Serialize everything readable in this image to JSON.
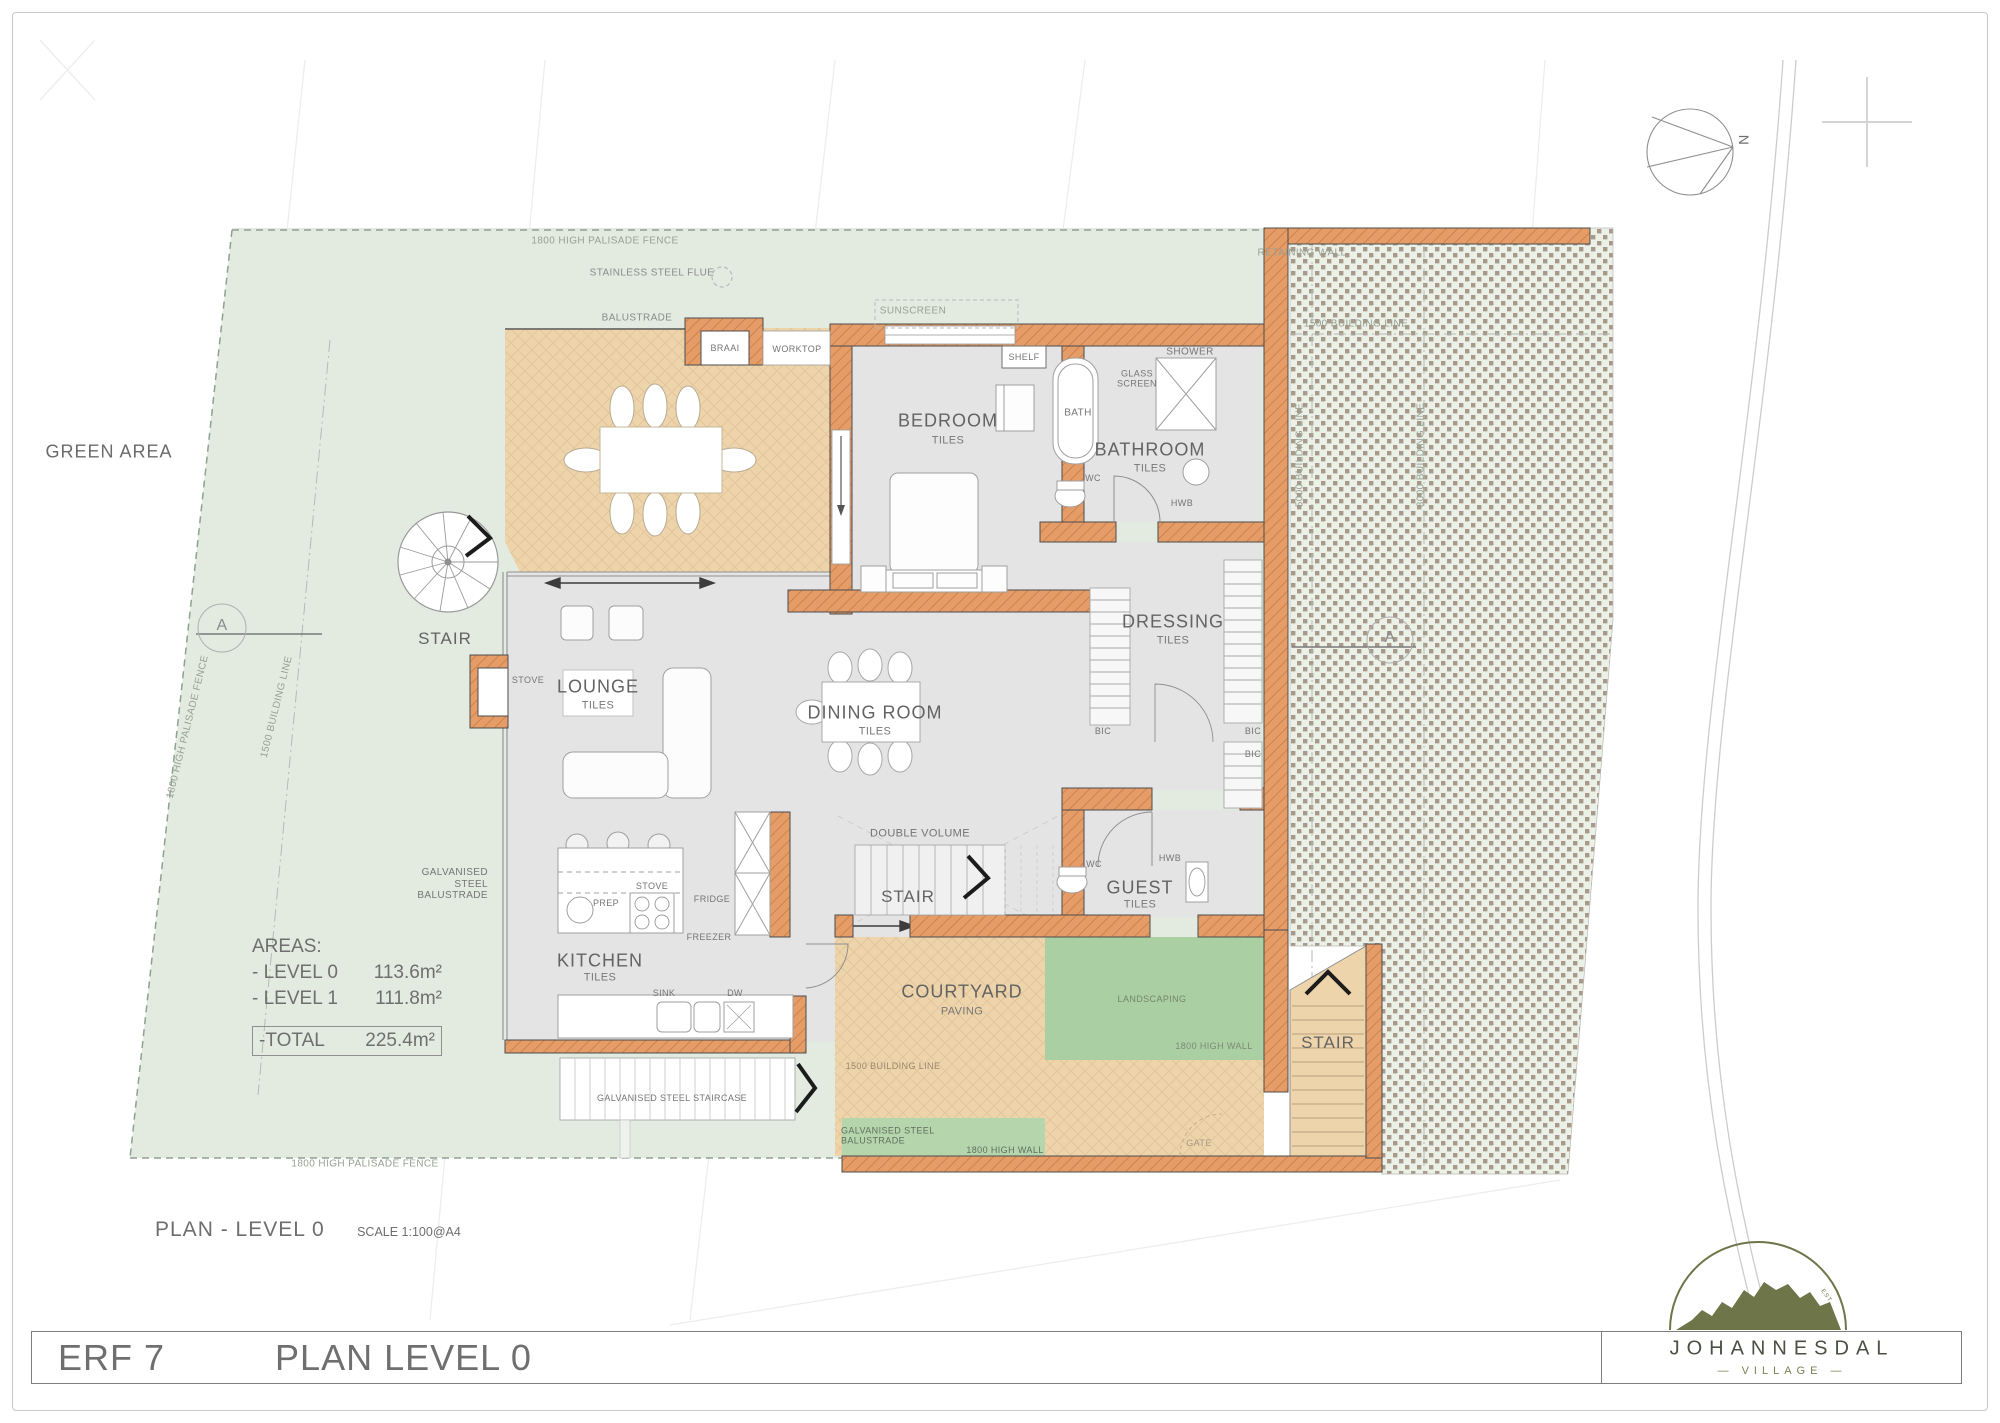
{
  "title_block": {
    "erf": "ERF 7",
    "plan": "PLAN LEVEL 0"
  },
  "caption": {
    "title": "PLAN - LEVEL 0",
    "scale": "SCALE 1:100@A4"
  },
  "logo": {
    "name": "JOHANNESDAL",
    "subtitle": "— VILLAGE —",
    "est": "EST"
  },
  "north": "N",
  "areas": {
    "heading": "AREAS:",
    "rows": [
      {
        "label": "- LEVEL 0",
        "value": "113.6m²"
      },
      {
        "label": "- LEVEL 1",
        "value": "111.8m²"
      }
    ],
    "total_label": "-TOTAL",
    "total_value": "225.4m²"
  },
  "rooms": {
    "patio": {
      "name": "PATIO",
      "sub": "TILES"
    },
    "bedroom": {
      "name": "BEDROOM",
      "sub": "TILES"
    },
    "bathroom": {
      "name": "BATHROOM",
      "sub": "TILES"
    },
    "dressing": {
      "name": "DRESSING",
      "sub": "TILES"
    },
    "lounge": {
      "name": "LOUNGE",
      "sub": "TILES"
    },
    "dining": {
      "name": "DINING ROOM",
      "sub": "TILES"
    },
    "kitchen": {
      "name": "KITCHEN",
      "sub": "TILES"
    },
    "guest": {
      "name": "GUEST",
      "sub": "TILES"
    },
    "courtyard": {
      "name": "COURTYARD",
      "sub": "PAVING"
    }
  },
  "stairs": {
    "spiral": "STAIR",
    "interior": "STAIR",
    "outdoor": "STAIR",
    "double_volume": "DOUBLE VOLUME",
    "galvanised_staircase": "GALVANISED STEEL STAIRCASE"
  },
  "site": {
    "green_area": "GREEN AREA",
    "fence_top": "1800 HIGH PALISADE FENCE",
    "fence_left": "1800 HIGH PALISADE FENCE",
    "fence_bottom": "1800 HIGH PALISADE FENCE",
    "building_line_left": "1500 BUILDING LINE",
    "building_line_top_right": "1500 BUILDING LINE",
    "building_line_5000": "5000 BUILDING LINE",
    "building_line_3000": "3000 BUILDING LINE",
    "building_line_courtyard": "1500 BUILDING LINE",
    "retaining_wall": "RETAINING WALL",
    "landscaping": "LANDSCAPING",
    "high_wall_landscaping": "1800 HIGH WALL",
    "high_wall_south": "1800 HIGH WALL",
    "gate": "GATE",
    "section_a_left": "A",
    "section_a_right": "A"
  },
  "fixtures": {
    "stainless_steel_flue": "STAINLESS STEEL FLUE",
    "balustrade": "BALUSTRADE",
    "braai": "BRAAI",
    "worktop": "WORKTOP",
    "sunscreen": "SUNSCREEN",
    "shelf": "SHELF",
    "bath": "BATH",
    "glass_screen": "GLASS SCREEN",
    "shower": "SHOWER",
    "wc_bathroom": "WC",
    "hwb_bathroom": "HWB",
    "wc_guest": "WC",
    "hwb_guest": "HWB",
    "bic_1": "BIC",
    "bic_2": "BIC",
    "bic_3": "BIC",
    "stove_fireplace": "STOVE",
    "stove_kitchen": "STOVE",
    "prep": "PREP",
    "fridge": "FRIDGE",
    "freezer": "FREEZER",
    "sink": "SINK",
    "dw": "DW",
    "galvanised_balustrade_west": "GALVANISED STEEL BALUSTRADE",
    "galvanised_balustrade_south": "GALVANISED STEEL BALUSTRADE"
  },
  "colors": {
    "wall": "#e69c66",
    "paving": "#edd4ab",
    "room_floor": "#e4e4e4",
    "site_green": "#e3ebe1",
    "landscaping_green": "#a9cfa3",
    "stipple_bg": "#ecf1e8",
    "stipple_dot": "#a79a8a",
    "logo_olive": "#6d7549"
  }
}
